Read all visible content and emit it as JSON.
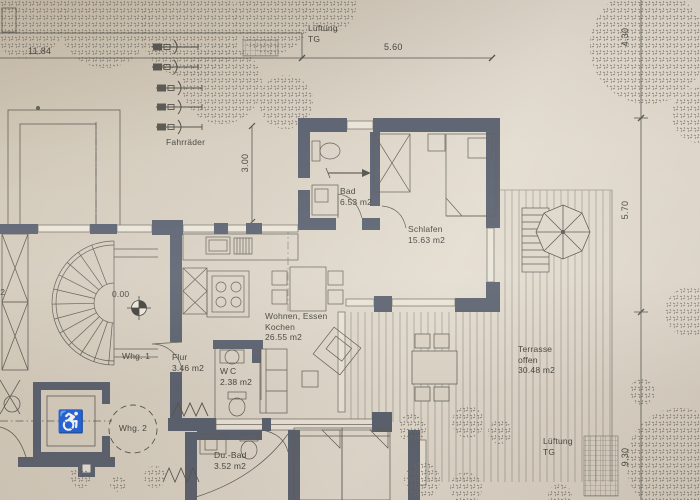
{
  "plan": {
    "rooms": [
      {
        "id": "bad",
        "name": "Bad",
        "area": "6.53 m2"
      },
      {
        "id": "schlafen",
        "name": "Schlafen",
        "area": "15.63 m2"
      },
      {
        "id": "wohnen",
        "line1": "Wohnen, Essen",
        "line2": "Kochen",
        "area": "26.55 m2"
      },
      {
        "id": "flur",
        "name": "Flur",
        "area": "3.46 m2"
      },
      {
        "id": "wc",
        "name": "WC",
        "area": "2.38 m2"
      },
      {
        "id": "dubad",
        "name": "Du.-Bad",
        "area": "3.52 m2"
      },
      {
        "id": "terrasse",
        "line1": "Terrasse",
        "line2": "offen",
        "area": "30.48 m2"
      }
    ],
    "labels": {
      "fahrraeder": "Fahrräder",
      "lueftung_top_line1": "Lüftung",
      "lueftung_top_line2": "TG",
      "lueftung_bottom_line1": "Lüftung",
      "lueftung_bottom_line2": "TG",
      "whg1": "Whg. 1",
      "whg2": "Whg. 2",
      "level": "0.00",
      "partial_left": "m2"
    },
    "dimensions": {
      "top_left": "11.84",
      "top": "5.60",
      "bikes": "3.00",
      "right_upper": "4.30",
      "right_middle": "5.70",
      "right_lower": "9.30"
    },
    "colors": {
      "paper": "#d9d1c4",
      "wall": "#59606e",
      "line": "#55544e",
      "text": "#45443e"
    }
  }
}
